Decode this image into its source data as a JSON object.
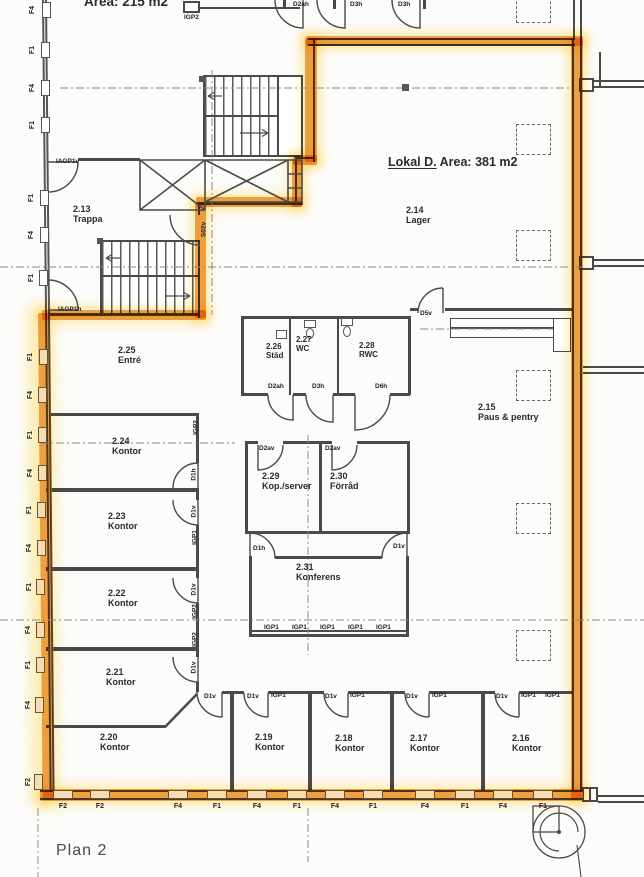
{
  "plan_title": "Plan 2",
  "top_area_label": "Area: 215 m2",
  "lokal": {
    "name": "Lokal  D.",
    "area": "Area: 381 m2"
  },
  "rooms": [
    {
      "id": "2.13",
      "name": "Trappa"
    },
    {
      "id": "2.14",
      "name": "Lager"
    },
    {
      "id": "2.25",
      "name": "Entré"
    },
    {
      "id": "2.26",
      "name": "Städ"
    },
    {
      "id": "2.27",
      "name": "WC"
    },
    {
      "id": "2.28",
      "name": "RWC"
    },
    {
      "id": "2.15",
      "name": "Paus & pentry"
    },
    {
      "id": "2.24",
      "name": "Kontor"
    },
    {
      "id": "2.23",
      "name": "Kontor"
    },
    {
      "id": "2.22",
      "name": "Kontor"
    },
    {
      "id": "2.21",
      "name": "Kontor"
    },
    {
      "id": "2.20",
      "name": "Kontor"
    },
    {
      "id": "2.19",
      "name": "Kontor"
    },
    {
      "id": "2.18",
      "name": "Kontor"
    },
    {
      "id": "2.17",
      "name": "Kontor"
    },
    {
      "id": "2.16",
      "name": "Kontor"
    },
    {
      "id": "2.29",
      "name": "Kop./server"
    },
    {
      "id": "2.30",
      "name": "Förråd"
    },
    {
      "id": "2.31",
      "name": "Konferens"
    }
  ],
  "door_labels": [
    "IGP2",
    "D2ah",
    "D3h",
    "D3h",
    "IAGP1v",
    "IAGP1h",
    "S02v",
    "D2ah",
    "D3h",
    "D6h",
    "D5v",
    "D2av",
    "D2av",
    "IGP2",
    "D1h",
    "D1v",
    "IGP1",
    "D1v",
    "IGP2",
    "IGP2",
    "D1v",
    "D1h",
    "D1v",
    "IGP1",
    "IGP1",
    "IGP1",
    "IGP1",
    "IGP1",
    "D1v",
    "D1v",
    "IGP1",
    "D1v",
    "IGP1",
    "D1v",
    "IGP1",
    "D1v",
    "IGP1",
    "IGP1"
  ],
  "window_labels_left": [
    "F4",
    "F1",
    "F4",
    "F1",
    "F1",
    "F4",
    "F1",
    "F1",
    "F4",
    "F1",
    "F4",
    "F1",
    "F4",
    "F1",
    "F4",
    "F1",
    "F4",
    "F2"
  ],
  "window_labels_bottom": [
    "F2",
    "F2",
    "F4",
    "F1",
    "F4",
    "F1",
    "F4",
    "F1",
    "F4",
    "F1",
    "F4",
    "F1"
  ],
  "colors": {
    "highlight": "#f0a040",
    "glow": "#ffe27a",
    "wall": "#4a4a4a",
    "paper": "#fcfcfa"
  }
}
